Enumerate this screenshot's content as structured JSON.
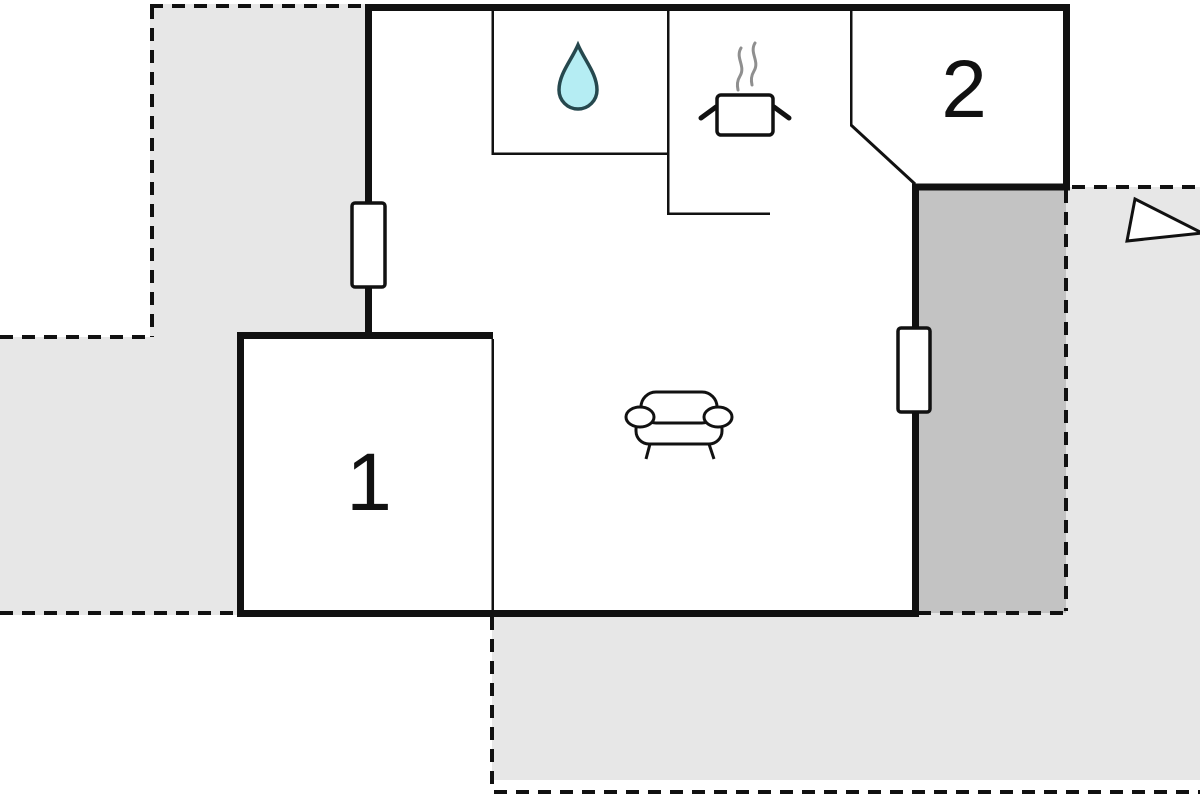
{
  "plan": {
    "type": "floor-plan",
    "rooms": {
      "room1": {
        "label": "1"
      },
      "room2": {
        "label": "2"
      }
    },
    "icons": {
      "water_drop": "water-drop-icon",
      "cooking_pot": "cooking-pot-icon",
      "sofa": "sofa-icon",
      "triangle": "direction-triangle-icon",
      "window": "window-marker"
    },
    "colors": {
      "line": "#111111",
      "terrace_light": "#e7e7e7",
      "terrace_dark": "#c3c3c3",
      "house_fill": "#ffffff",
      "drop_fill": "#b5edf3",
      "drop_stroke": "#26484e",
      "steam": "#8f8f8f",
      "label": "#111111"
    }
  }
}
